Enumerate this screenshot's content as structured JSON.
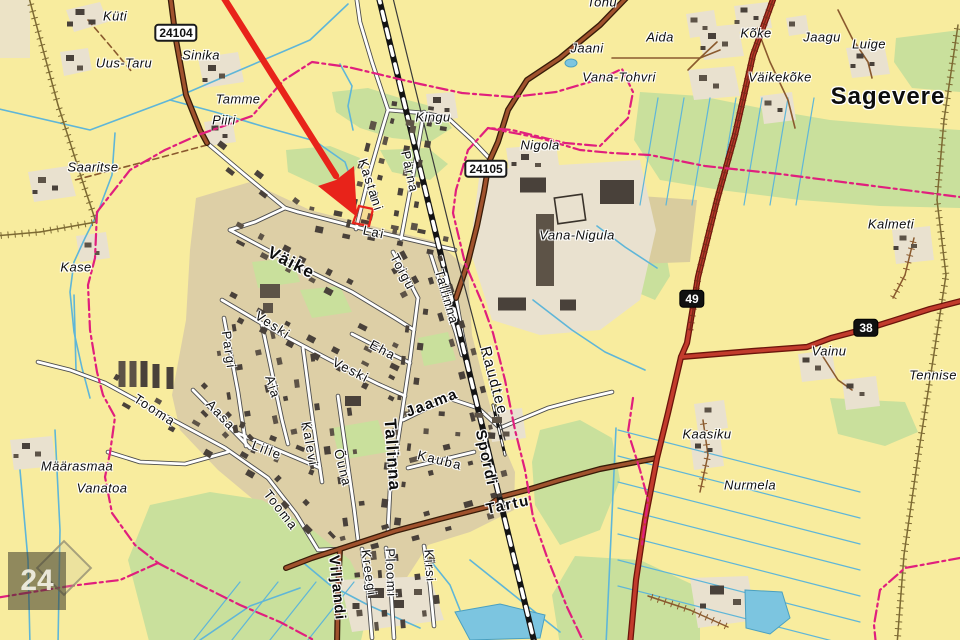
{
  "map": {
    "colors": {
      "background": "#f8ec9e",
      "town_area": "#ddcfa6",
      "farm_patch": "#e9e1cf",
      "green": "#c9e09c",
      "green_dark": "#b9d68c",
      "khaki_field": "#d9cc9e",
      "water": "#5fb6d8",
      "pond": "#7cc5e0",
      "road_white": "#ffffff",
      "road_casing": "#4d4d4d",
      "road_brown": "#a0522d",
      "road_brown_casing": "#381c08",
      "road_red": "#c23b2c",
      "road_red_casing": "#6b150b",
      "railway": "#141414",
      "boundary_magenta": "#e01f7d",
      "building": "#49413a",
      "building_alt": "#5d5347",
      "tree_rope": "#7d6a33",
      "track_brown": "#8a5a2e",
      "arrow_red": "#e8231a",
      "label_color": "#0d0d0d"
    },
    "labels": [
      {
        "name": "kuti",
        "text": "Küti",
        "x": 115,
        "y": 16,
        "rot": 0,
        "cls": "place"
      },
      {
        "name": "uus-taru",
        "text": "Uus-Taru",
        "x": 124,
        "y": 63,
        "rot": 0,
        "cls": "place"
      },
      {
        "name": "sinika",
        "text": "Sinika",
        "x": 201,
        "y": 55,
        "rot": 0,
        "cls": "place"
      },
      {
        "name": "tamme",
        "text": "Tamme",
        "x": 238,
        "y": 99,
        "rot": 0,
        "cls": "place"
      },
      {
        "name": "piiri",
        "text": "Piiri",
        "x": 224,
        "y": 120,
        "rot": 0,
        "cls": "place"
      },
      {
        "name": "saaritse",
        "text": "Saaritse",
        "x": 93,
        "y": 167,
        "rot": 0,
        "cls": "place"
      },
      {
        "name": "kase",
        "text": "Kase",
        "x": 76,
        "y": 267,
        "rot": 0,
        "cls": "place"
      },
      {
        "name": "kingu",
        "text": "Kingu",
        "x": 433,
        "y": 117,
        "rot": 0,
        "cls": "place"
      },
      {
        "name": "nigola",
        "text": "Nigola",
        "x": 540,
        "y": 145,
        "rot": 0,
        "cls": "place"
      },
      {
        "name": "jaani",
        "text": "Jaani",
        "x": 587,
        "y": 48,
        "rot": 0,
        "cls": "place"
      },
      {
        "name": "vana-tohvri",
        "text": "Vana-Tohvri",
        "x": 619,
        "y": 77,
        "rot": 0,
        "cls": "place"
      },
      {
        "name": "tohu",
        "text": "Tohu",
        "x": 602,
        "y": 2,
        "rot": 0,
        "cls": "place"
      },
      {
        "name": "aida",
        "text": "Aida",
        "x": 660,
        "y": 37,
        "rot": 0,
        "cls": "place"
      },
      {
        "name": "koke",
        "text": "Kõke",
        "x": 756,
        "y": 33,
        "rot": 0,
        "cls": "place"
      },
      {
        "name": "jaagu",
        "text": "Jaagu",
        "x": 822,
        "y": 37,
        "rot": 0,
        "cls": "place"
      },
      {
        "name": "luige",
        "text": "Luige",
        "x": 869,
        "y": 44,
        "rot": 0,
        "cls": "place"
      },
      {
        "name": "vaikekoke",
        "text": "Väikekõke",
        "x": 780,
        "y": 77,
        "rot": 0,
        "cls": "place"
      },
      {
        "name": "sagevere",
        "text": "Sagevere",
        "x": 888,
        "y": 97,
        "rot": 0,
        "cls": "place-lg"
      },
      {
        "name": "kalmeti",
        "text": "Kalmeti",
        "x": 891,
        "y": 224,
        "rot": 0,
        "cls": "place"
      },
      {
        "name": "vainu",
        "text": "Vainu",
        "x": 829,
        "y": 351,
        "rot": 0,
        "cls": "place"
      },
      {
        "name": "tennise",
        "text": "Tennise",
        "x": 933,
        "y": 375,
        "rot": 0,
        "cls": "place"
      },
      {
        "name": "kaasiku",
        "text": "Kaasiku",
        "x": 707,
        "y": 434,
        "rot": 0,
        "cls": "place"
      },
      {
        "name": "nurmela",
        "text": "Nurmela",
        "x": 750,
        "y": 485,
        "rot": 0,
        "cls": "place"
      },
      {
        "name": "maarasmaa",
        "text": "Määrasmaa",
        "x": 77,
        "y": 466,
        "rot": 0,
        "cls": "place"
      },
      {
        "name": "vanatoa",
        "text": "Vanatoa",
        "x": 102,
        "y": 488,
        "rot": 0,
        "cls": "place"
      },
      {
        "name": "vana-nigula",
        "text": "Vana-Nigula",
        "x": 577,
        "y": 235,
        "rot": 0,
        "cls": "place"
      },
      {
        "name": "kastani-street",
        "text": "Kastani",
        "x": 371,
        "y": 185,
        "rot": 72,
        "cls": "street"
      },
      {
        "name": "parna-street",
        "text": "Pärna",
        "x": 410,
        "y": 172,
        "rot": 78,
        "cls": "street"
      },
      {
        "name": "lai-street",
        "text": "Lai",
        "x": 374,
        "y": 232,
        "rot": 12,
        "cls": "street"
      },
      {
        "name": "toigu-street",
        "text": "Toigu",
        "x": 403,
        "y": 272,
        "rot": 62,
        "cls": "street"
      },
      {
        "name": "vaike-street",
        "text": "Väike",
        "x": 291,
        "y": 263,
        "rot": 27,
        "cls": "street-bb"
      },
      {
        "name": "veski-street-1",
        "text": "Veski",
        "x": 273,
        "y": 325,
        "rot": 33,
        "cls": "street"
      },
      {
        "name": "veski-street-2",
        "text": "Veski",
        "x": 351,
        "y": 370,
        "rot": 27,
        "cls": "street"
      },
      {
        "name": "eha-street",
        "text": "Eha",
        "x": 383,
        "y": 350,
        "rot": 28,
        "cls": "street"
      },
      {
        "name": "pargi-street",
        "text": "Pargi",
        "x": 229,
        "y": 350,
        "rot": 82,
        "cls": "street"
      },
      {
        "name": "aia-street",
        "text": "Aia",
        "x": 273,
        "y": 387,
        "rot": 72,
        "cls": "street"
      },
      {
        "name": "aasa-street",
        "text": "Aasa",
        "x": 221,
        "y": 415,
        "rot": 47,
        "cls": "street"
      },
      {
        "name": "lille-street",
        "text": "Lille",
        "x": 267,
        "y": 450,
        "rot": 21,
        "cls": "street"
      },
      {
        "name": "kalevi-street",
        "text": "Kalevi",
        "x": 310,
        "y": 444,
        "rot": 80,
        "cls": "street"
      },
      {
        "name": "ouna-street",
        "text": "Õuna",
        "x": 343,
        "y": 468,
        "rot": 76,
        "cls": "street"
      },
      {
        "name": "tooma-street-1",
        "text": "Tooma",
        "x": 155,
        "y": 410,
        "rot": 33,
        "cls": "street"
      },
      {
        "name": "tooma-street-2",
        "text": "Tooma",
        "x": 281,
        "y": 510,
        "rot": 52,
        "cls": "street"
      },
      {
        "name": "tallinna-street",
        "text": "Tallinna",
        "x": 447,
        "y": 297,
        "rot": 74,
        "cls": "street"
      },
      {
        "name": "tallinna-main-street",
        "text": "Tallinna",
        "x": 392,
        "y": 455,
        "rot": 86,
        "cls": "street-bb"
      },
      {
        "name": "jaama-street",
        "text": "Jaama",
        "x": 432,
        "y": 403,
        "rot": -21,
        "cls": "street-b"
      },
      {
        "name": "spordi-street",
        "text": "Spordi",
        "x": 486,
        "y": 458,
        "rot": 78,
        "cls": "street-b"
      },
      {
        "name": "kauba-street",
        "text": "Kauba",
        "x": 440,
        "y": 460,
        "rot": 14,
        "cls": "street"
      },
      {
        "name": "raudtee-street",
        "text": "Raudtee",
        "x": 494,
        "y": 381,
        "rot": 75,
        "cls": "street-lg"
      },
      {
        "name": "tartu-road",
        "text": "Tartu",
        "x": 508,
        "y": 505,
        "rot": -12,
        "cls": "street-b"
      },
      {
        "name": "viljandi-road",
        "text": "Viljandi",
        "x": 337,
        "y": 588,
        "rot": 84,
        "cls": "street-b"
      },
      {
        "name": "kreegi-street",
        "text": "Kreegi",
        "x": 369,
        "y": 573,
        "rot": 82,
        "cls": "street"
      },
      {
        "name": "ploomi-street",
        "text": "Ploomi",
        "x": 391,
        "y": 573,
        "rot": 88,
        "cls": "street"
      },
      {
        "name": "kirsi-street",
        "text": "Kirsi",
        "x": 430,
        "y": 566,
        "rot": 86,
        "cls": "street"
      }
    ],
    "road_badges": [
      {
        "name": "road-badge-24104",
        "text": "24104",
        "x": 176,
        "y": 33,
        "style": "white"
      },
      {
        "name": "road-badge-24105",
        "text": "24105",
        "x": 486,
        "y": 169,
        "style": "white"
      },
      {
        "name": "road-badge-49",
        "text": "49",
        "x": 692,
        "y": 299,
        "style": "black"
      },
      {
        "name": "road-badge-38",
        "text": "38",
        "x": 866,
        "y": 328,
        "style": "black"
      }
    ],
    "sheet_badge": {
      "text": "24"
    }
  }
}
